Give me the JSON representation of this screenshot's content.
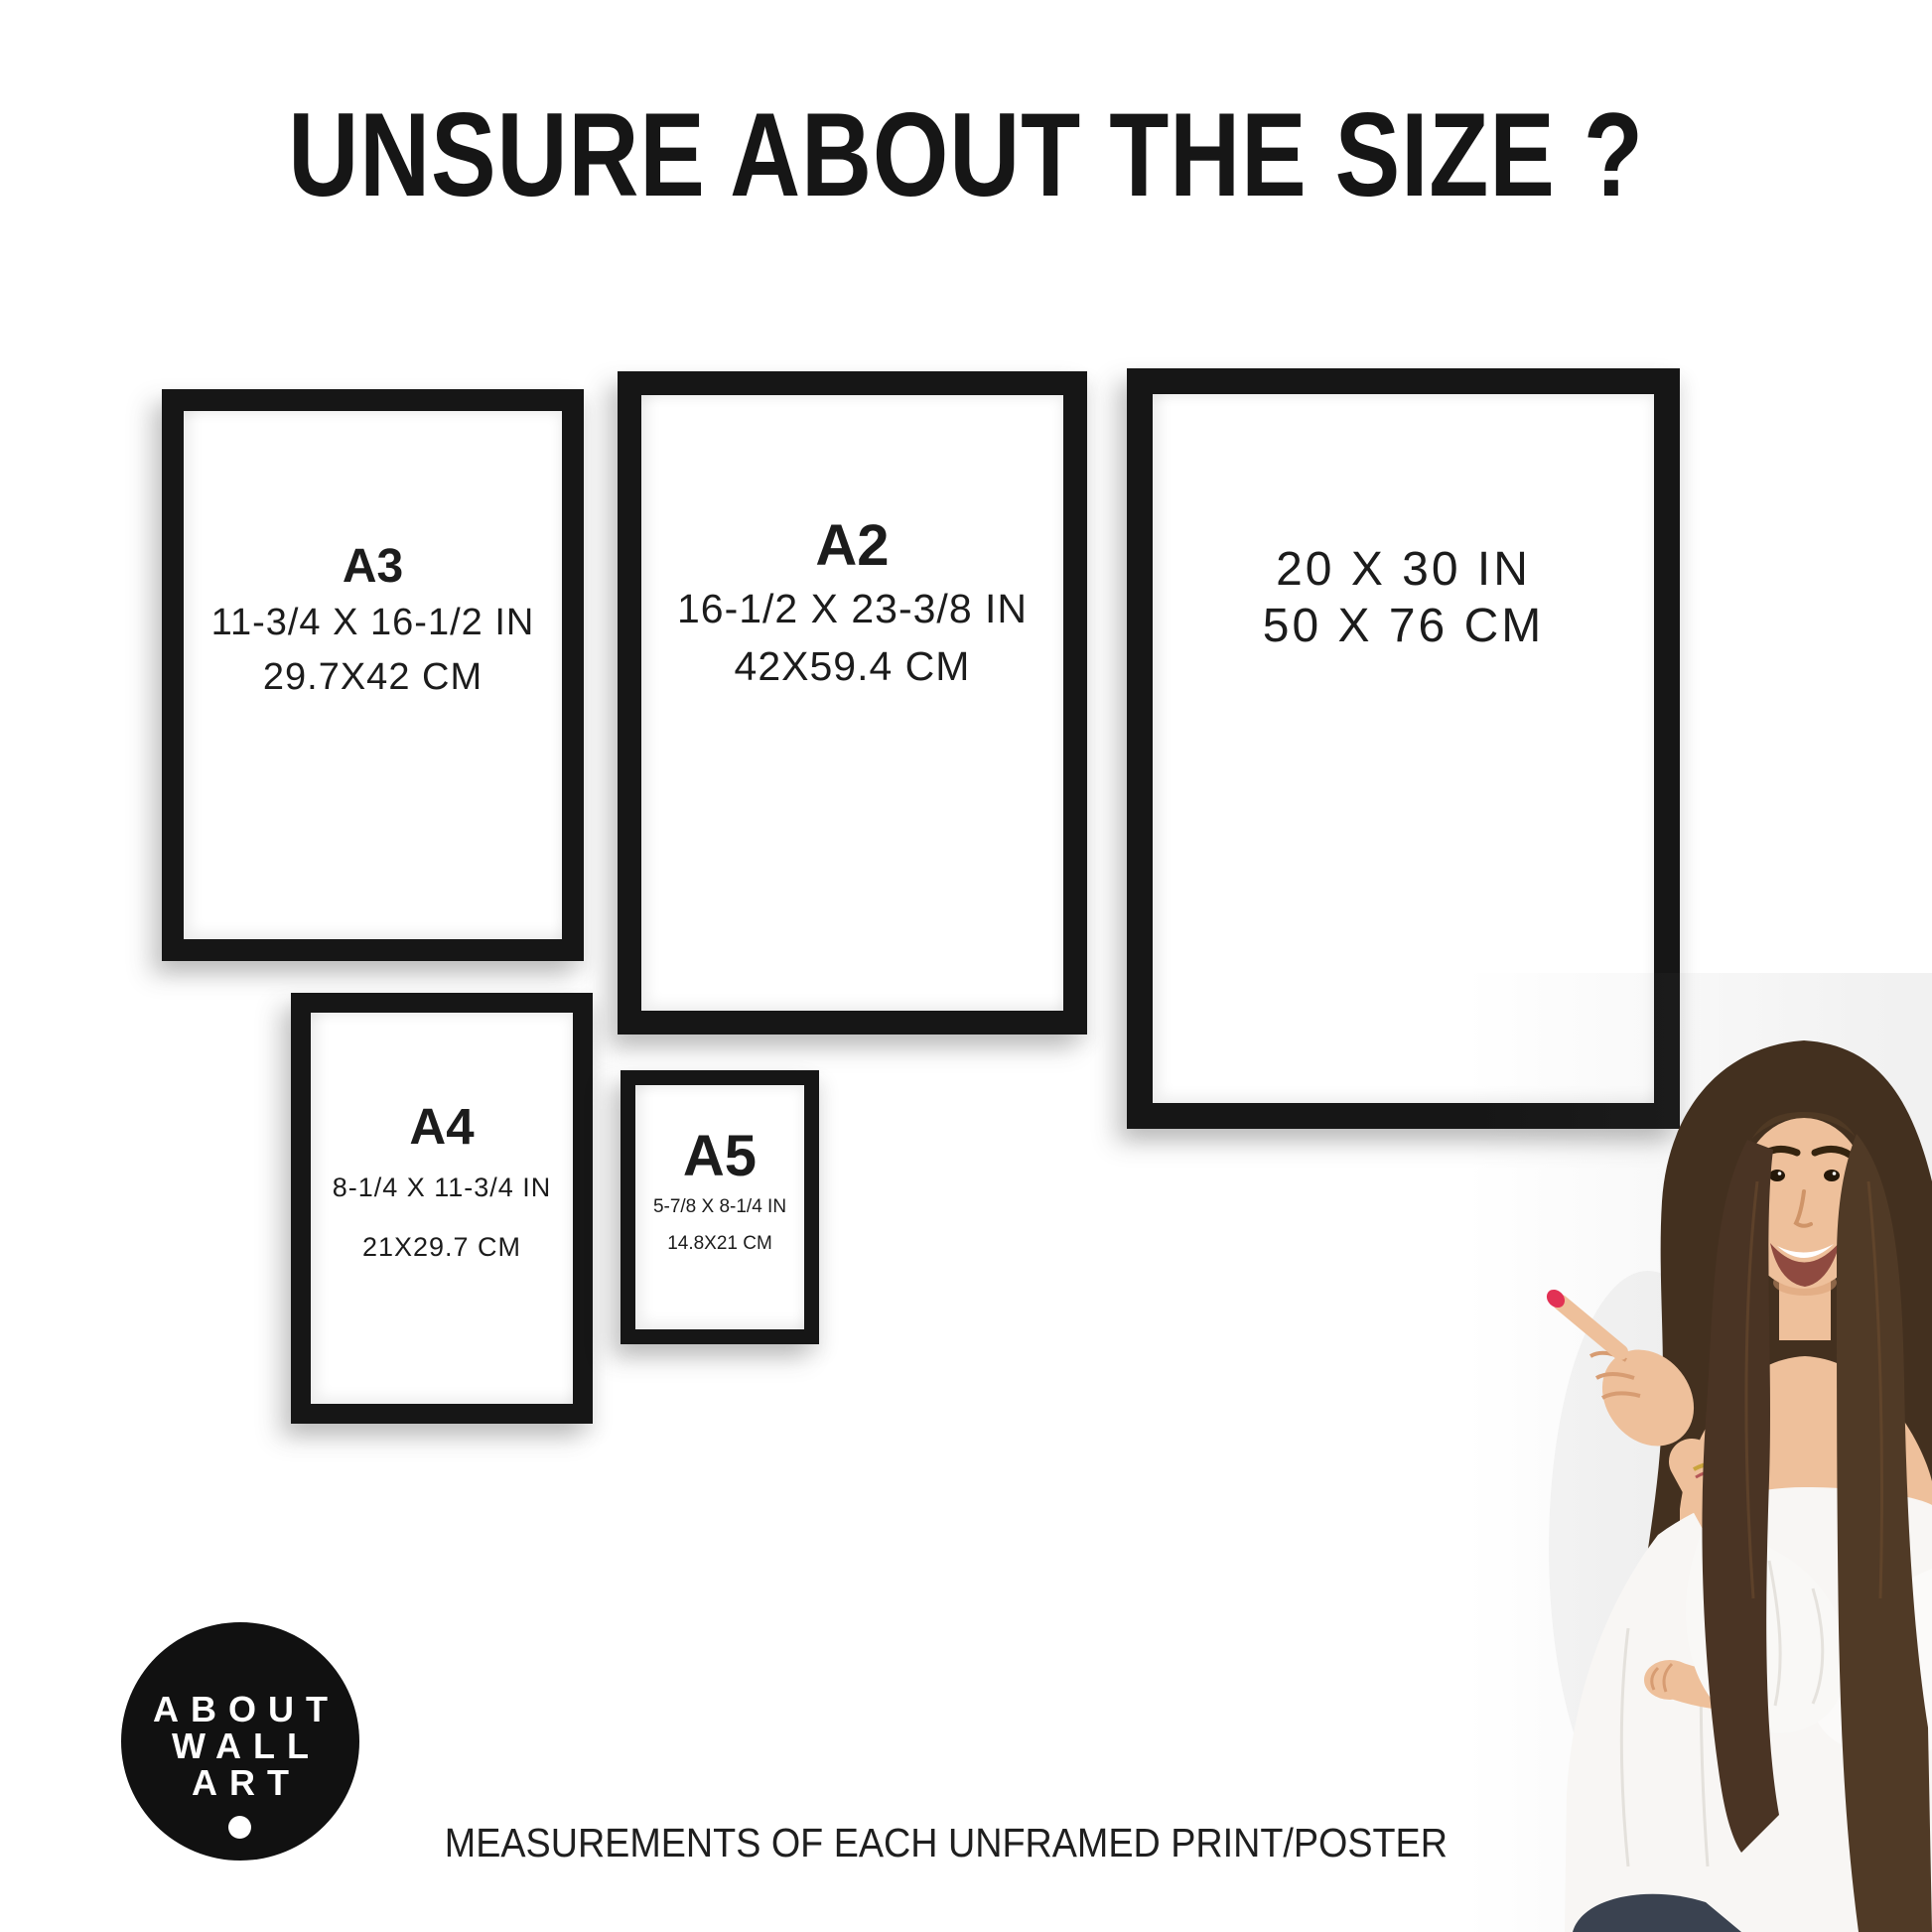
{
  "title": "UNSURE ABOUT THE SIZE ?",
  "footer": "MEASUREMENTS OF EACH UNFRAMED PRINT/POSTER",
  "frames": [
    {
      "name": "A3",
      "inches": "11-3/4 X 16-1/2 IN",
      "cm": "29.7X42 CM"
    },
    {
      "name": "A2",
      "inches": "16-1/2 X 23-3/8 IN",
      "cm": "42X59.4 CM"
    },
    {
      "name": "",
      "inches": "20 X 30 IN",
      "cm": "50 X 76 CM"
    },
    {
      "name": "A4",
      "inches": "8-1/4 X 11-3/4 IN",
      "cm": "21X29.7 CM"
    },
    {
      "name": "A5",
      "inches": "5-7/8 X 8-1/4 IN",
      "cm": "14.8X21 CM"
    }
  ],
  "logo": {
    "lines": [
      "ABOUT",
      "WALL",
      "ART"
    ]
  },
  "colors": {
    "ink": "#161616",
    "text": "#1c1c1c",
    "background": "#ffffff",
    "logo_bg": "#111111",
    "logo_text": "#ffffff",
    "nail_polish": "#e23154",
    "hair": "#47311f",
    "skin": "#eec09b",
    "blouse": "#f8f6f4",
    "jeans": "#3a4250"
  }
}
